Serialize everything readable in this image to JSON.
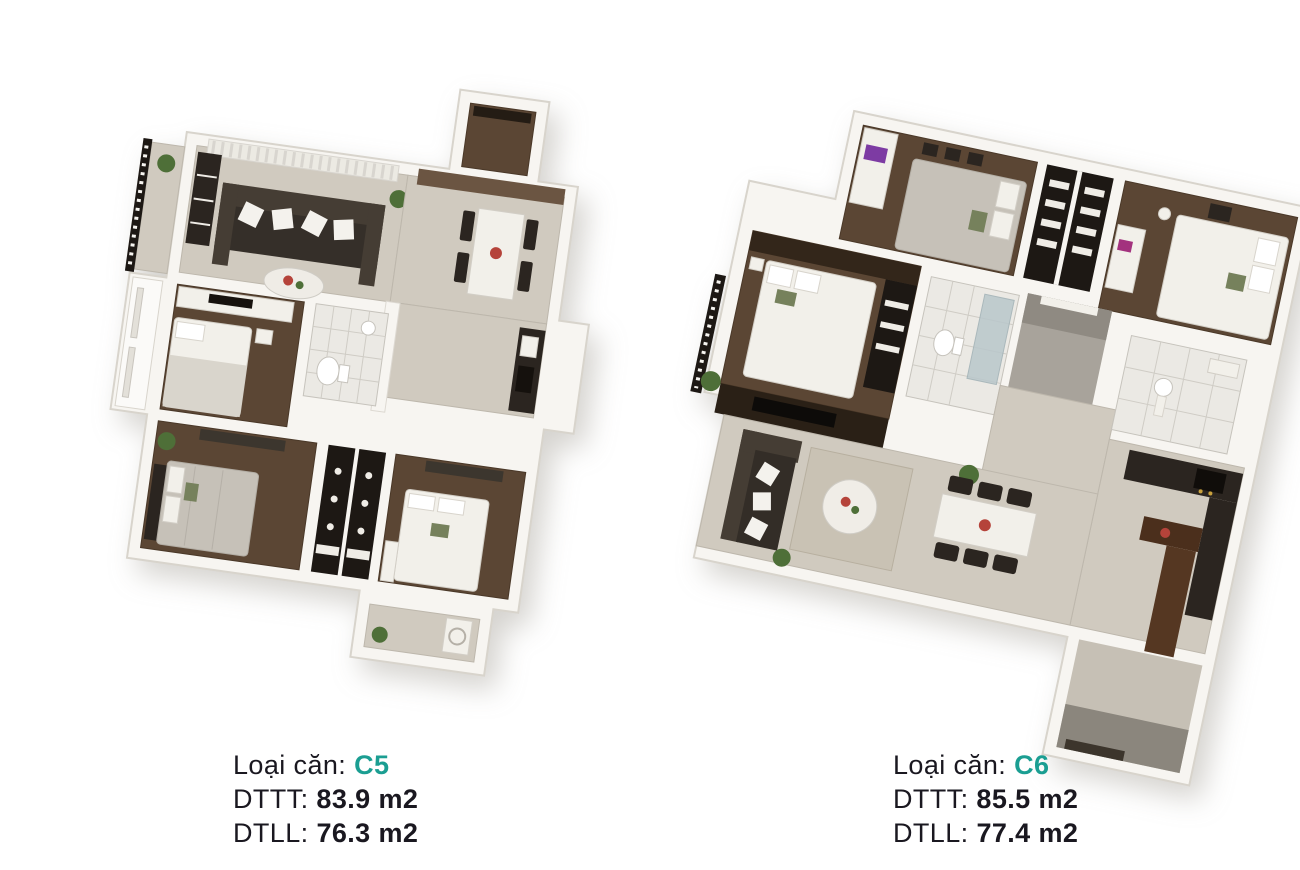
{
  "page": {
    "background": "#ffffff"
  },
  "palette": {
    "accent_teal": "#1b9e92",
    "text_dark": "#1a1820",
    "wall_white": "#f7f5f1",
    "floor_tile": "#d0cabf",
    "floor_wood": "#5b4634",
    "furniture_dark": "#2b2520",
    "plant_green": "#4e6f38"
  },
  "figures": [
    {
      "id": "c5",
      "caption": {
        "type_label": "Loại căn:",
        "type_value": "C5",
        "dttt_label": "DTTT:",
        "dttt_value": "83.9 m2",
        "dtll_label": "DTLL:",
        "dtll_value": "76.3 m2"
      }
    },
    {
      "id": "c6",
      "caption": {
        "type_label": "Loại căn:",
        "type_value": "C6",
        "dttt_label": "DTTT:",
        "dttt_value": "85.5 m2",
        "dtll_label": "DTLL:",
        "dtll_value": "77.4 m2"
      }
    }
  ]
}
